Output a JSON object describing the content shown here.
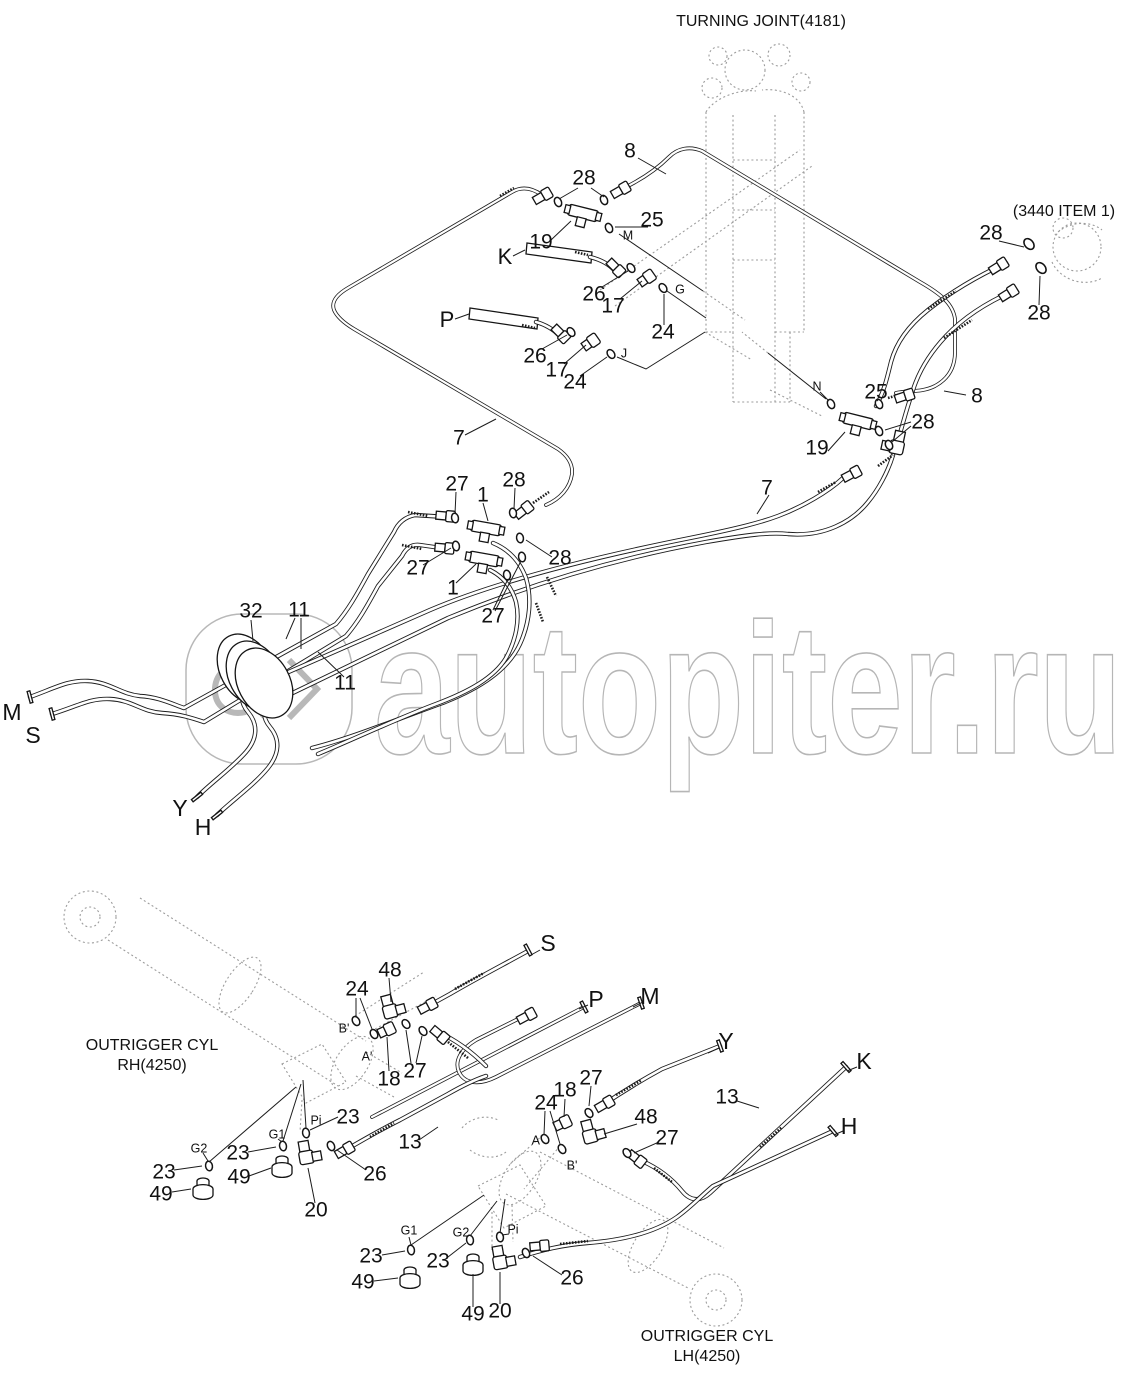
{
  "watermark": {
    "text": "autopiter.ru"
  },
  "colors": {
    "line": "#1c1c1c",
    "ghost": "#9c9c9c",
    "watermark": "#b6b6b6",
    "background": "#ffffff"
  },
  "labels": [
    {
      "t": "TURNING JOINT(4181)",
      "x": 761,
      "y": 22,
      "s": 16,
      "k": "title"
    },
    {
      "t": "(3440 ITEM 1)",
      "x": 1064,
      "y": 212,
      "s": 16,
      "k": "ref"
    },
    {
      "t": "OUTRIGGER CYL",
      "x": 152,
      "y": 1046,
      "s": 16,
      "k": "ref"
    },
    {
      "t": "RH(4250)",
      "x": 152,
      "y": 1066,
      "s": 16,
      "k": "ref"
    },
    {
      "t": "OUTRIGGER CYL",
      "x": 707,
      "y": 1337,
      "s": 16,
      "k": "ref"
    },
    {
      "t": "LH(4250)",
      "x": 707,
      "y": 1357,
      "s": 16,
      "k": "ref"
    },
    {
      "t": "8",
      "x": 630,
      "y": 152,
      "s": 21,
      "k": "part"
    },
    {
      "t": "28",
      "x": 584,
      "y": 179,
      "s": 21,
      "k": "part"
    },
    {
      "t": "25",
      "x": 652,
      "y": 221,
      "s": 21,
      "k": "part"
    },
    {
      "t": "19",
      "x": 541,
      "y": 243,
      "s": 21,
      "k": "part"
    },
    {
      "t": "26",
      "x": 594,
      "y": 295,
      "s": 21,
      "k": "part"
    },
    {
      "t": "17",
      "x": 613,
      "y": 307,
      "s": 21,
      "k": "part"
    },
    {
      "t": "24",
      "x": 663,
      "y": 333,
      "s": 21,
      "k": "part"
    },
    {
      "t": "26",
      "x": 535,
      "y": 357,
      "s": 21,
      "k": "part"
    },
    {
      "t": "17",
      "x": 557,
      "y": 371,
      "s": 21,
      "k": "part"
    },
    {
      "t": "24",
      "x": 575,
      "y": 383,
      "s": 21,
      "k": "part"
    },
    {
      "t": "28",
      "x": 991,
      "y": 234,
      "s": 21,
      "k": "part"
    },
    {
      "t": "28",
      "x": 1039,
      "y": 314,
      "s": 21,
      "k": "part"
    },
    {
      "t": "8",
      "x": 977,
      "y": 397,
      "s": 21,
      "k": "part"
    },
    {
      "t": "25",
      "x": 876,
      "y": 393,
      "s": 21,
      "k": "part"
    },
    {
      "t": "28",
      "x": 923,
      "y": 423,
      "s": 21,
      "k": "part"
    },
    {
      "t": "19",
      "x": 817,
      "y": 449,
      "s": 21,
      "k": "part"
    },
    {
      "t": "7",
      "x": 459,
      "y": 439,
      "s": 21,
      "k": "part"
    },
    {
      "t": "7",
      "x": 767,
      "y": 489,
      "s": 21,
      "k": "part"
    },
    {
      "t": "27",
      "x": 457,
      "y": 485,
      "s": 21,
      "k": "part"
    },
    {
      "t": "1",
      "x": 483,
      "y": 496,
      "s": 21,
      "k": "part"
    },
    {
      "t": "28",
      "x": 514,
      "y": 481,
      "s": 21,
      "k": "part"
    },
    {
      "t": "27",
      "x": 418,
      "y": 569,
      "s": 21,
      "k": "part"
    },
    {
      "t": "1",
      "x": 453,
      "y": 589,
      "s": 21,
      "k": "part"
    },
    {
      "t": "28",
      "x": 560,
      "y": 559,
      "s": 21,
      "k": "part"
    },
    {
      "t": "27",
      "x": 493,
      "y": 617,
      "s": 21,
      "k": "part"
    },
    {
      "t": "32",
      "x": 251,
      "y": 612,
      "s": 21,
      "k": "part"
    },
    {
      "t": "11",
      "x": 299,
      "y": 611,
      "s": 21,
      "k": "part"
    },
    {
      "t": "11",
      "x": 345,
      "y": 684,
      "s": 21,
      "k": "part"
    },
    {
      "t": "48",
      "x": 390,
      "y": 971,
      "s": 21,
      "k": "part"
    },
    {
      "t": "24",
      "x": 357,
      "y": 990,
      "s": 21,
      "k": "part"
    },
    {
      "t": "18",
      "x": 389,
      "y": 1080,
      "s": 21,
      "k": "part"
    },
    {
      "t": "27",
      "x": 415,
      "y": 1072,
      "s": 21,
      "k": "part"
    },
    {
      "t": "23",
      "x": 348,
      "y": 1118,
      "s": 21,
      "k": "part"
    },
    {
      "t": "23",
      "x": 238,
      "y": 1154,
      "s": 21,
      "k": "part"
    },
    {
      "t": "23",
      "x": 164,
      "y": 1173,
      "s": 21,
      "k": "part"
    },
    {
      "t": "49",
      "x": 239,
      "y": 1178,
      "s": 21,
      "k": "part"
    },
    {
      "t": "49",
      "x": 161,
      "y": 1195,
      "s": 21,
      "k": "part"
    },
    {
      "t": "26",
      "x": 375,
      "y": 1175,
      "s": 21,
      "k": "part"
    },
    {
      "t": "20",
      "x": 316,
      "y": 1211,
      "s": 21,
      "k": "part"
    },
    {
      "t": "13",
      "x": 410,
      "y": 1143,
      "s": 21,
      "k": "part"
    },
    {
      "t": "24",
      "x": 546,
      "y": 1104,
      "s": 21,
      "k": "part"
    },
    {
      "t": "18",
      "x": 565,
      "y": 1091,
      "s": 21,
      "k": "part"
    },
    {
      "t": "27",
      "x": 591,
      "y": 1079,
      "s": 21,
      "k": "part"
    },
    {
      "t": "13",
      "x": 727,
      "y": 1098,
      "s": 21,
      "k": "part"
    },
    {
      "t": "48",
      "x": 646,
      "y": 1118,
      "s": 21,
      "k": "part"
    },
    {
      "t": "27",
      "x": 667,
      "y": 1139,
      "s": 21,
      "k": "part"
    },
    {
      "t": "23",
      "x": 371,
      "y": 1257,
      "s": 21,
      "k": "part"
    },
    {
      "t": "23",
      "x": 438,
      "y": 1262,
      "s": 21,
      "k": "part"
    },
    {
      "t": "26",
      "x": 572,
      "y": 1279,
      "s": 21,
      "k": "part"
    },
    {
      "t": "49",
      "x": 363,
      "y": 1283,
      "s": 21,
      "k": "part"
    },
    {
      "t": "49",
      "x": 473,
      "y": 1315,
      "s": 21,
      "k": "part"
    },
    {
      "t": "20",
      "x": 500,
      "y": 1312,
      "s": 21,
      "k": "part"
    },
    {
      "t": "M",
      "x": 628,
      "y": 236,
      "s": 12.5,
      "k": "port"
    },
    {
      "t": "G",
      "x": 680,
      "y": 290,
      "s": 12.5,
      "k": "port"
    },
    {
      "t": "J",
      "x": 624,
      "y": 354,
      "s": 12.5,
      "k": "port"
    },
    {
      "t": "N",
      "x": 817,
      "y": 387,
      "s": 12.5,
      "k": "port"
    },
    {
      "t": "B'",
      "x": 344,
      "y": 1029,
      "s": 12.5,
      "k": "port"
    },
    {
      "t": "A'",
      "x": 367,
      "y": 1057,
      "s": 12.5,
      "k": "port"
    },
    {
      "t": "Pi",
      "x": 316,
      "y": 1121,
      "s": 12.5,
      "k": "port"
    },
    {
      "t": "G1",
      "x": 277,
      "y": 1135,
      "s": 12.5,
      "k": "port"
    },
    {
      "t": "G2",
      "x": 199,
      "y": 1149,
      "s": 12.5,
      "k": "port"
    },
    {
      "t": "A'",
      "x": 537,
      "y": 1141,
      "s": 12.5,
      "k": "port"
    },
    {
      "t": "B'",
      "x": 572,
      "y": 1166,
      "s": 12.5,
      "k": "port"
    },
    {
      "t": "G1",
      "x": 409,
      "y": 1231,
      "s": 12.5,
      "k": "port"
    },
    {
      "t": "G2",
      "x": 461,
      "y": 1233,
      "s": 12.5,
      "k": "port"
    },
    {
      "t": "Pi",
      "x": 513,
      "y": 1230,
      "s": 12.5,
      "k": "port"
    },
    {
      "t": "K",
      "x": 505,
      "y": 258,
      "s": 22,
      "k": "hose"
    },
    {
      "t": "P",
      "x": 447,
      "y": 321,
      "s": 22,
      "k": "hose"
    },
    {
      "t": "M",
      "x": 12,
      "y": 714,
      "s": 23,
      "k": "hose"
    },
    {
      "t": "S",
      "x": 33,
      "y": 737,
      "s": 23,
      "k": "hose"
    },
    {
      "t": "Y",
      "x": 180,
      "y": 810,
      "s": 23,
      "k": "hose"
    },
    {
      "t": "H",
      "x": 203,
      "y": 829,
      "s": 23,
      "k": "hose"
    },
    {
      "t": "S",
      "x": 548,
      "y": 945,
      "s": 23,
      "k": "hose"
    },
    {
      "t": "P",
      "x": 596,
      "y": 1001,
      "s": 23,
      "k": "hose"
    },
    {
      "t": "M",
      "x": 650,
      "y": 998,
      "s": 23,
      "k": "hose"
    },
    {
      "t": "Y",
      "x": 726,
      "y": 1043,
      "s": 23,
      "k": "hose"
    },
    {
      "t": "K",
      "x": 864,
      "y": 1063,
      "s": 23,
      "k": "hose"
    },
    {
      "t": "H",
      "x": 849,
      "y": 1128,
      "s": 23,
      "k": "hose"
    }
  ]
}
